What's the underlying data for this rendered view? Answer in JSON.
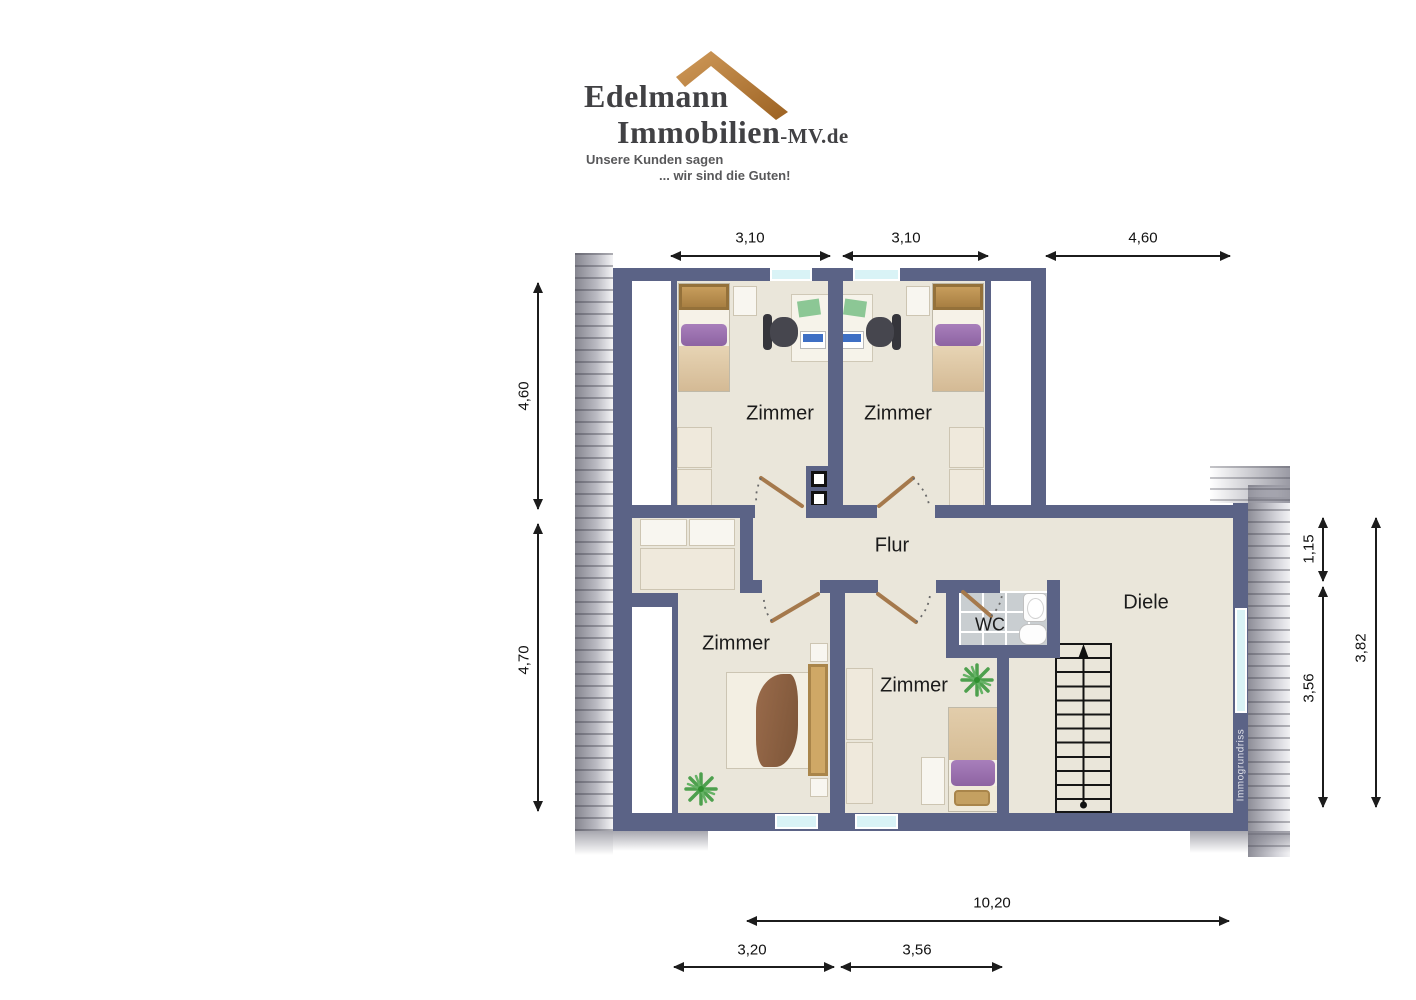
{
  "brand": {
    "name_line1": "Edelmann",
    "name_line2": "Immobilien",
    "name_suffix": "-MV.de",
    "tagline_line1": "Unsere Kunden sagen",
    "tagline_line2": "... wir sind die Guten!"
  },
  "plan": {
    "rooms": {
      "top_left": "Zimmer",
      "top_right": "Zimmer",
      "bottom_left": "Zimmer",
      "bottom_middle": "Zimmer",
      "hallway": "Flur",
      "wc": "WC",
      "entry_hall": "Diele"
    },
    "watermark": "Immogrundriss",
    "dimensions": {
      "top": [
        "3,10",
        "3,10",
        "4,60"
      ],
      "left": [
        "4,60",
        "4,70"
      ],
      "right": [
        "1,15",
        "3,56",
        "3,82"
      ],
      "bottom": [
        "10,20",
        "3,20",
        "3,56"
      ]
    },
    "colors": {
      "wall": "#5b6386",
      "floor": "#eae6da",
      "window": "#d9f3f6",
      "wc_tile": "#c9ced1",
      "roof_logo": "#b97b36"
    }
  }
}
